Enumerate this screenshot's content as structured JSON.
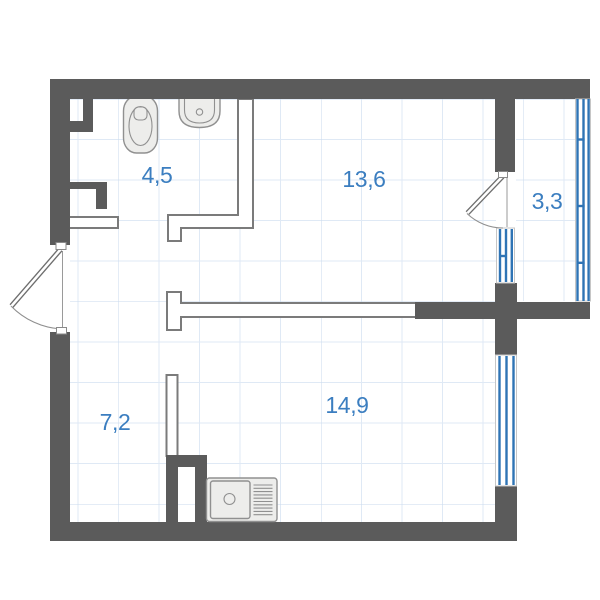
{
  "plan": {
    "rooms": [
      {
        "id": "bathroom",
        "area": "4,5"
      },
      {
        "id": "living-room",
        "area": "13,6"
      },
      {
        "id": "balcony",
        "area": "3,3"
      },
      {
        "id": "hallway",
        "area": "7,2"
      },
      {
        "id": "kitchen-living",
        "area": "14,9"
      }
    ],
    "colors": {
      "wall": "#5b5b5b",
      "partition": "#7b7b7b",
      "window": "#2f74b5",
      "label": "#3b7ec0",
      "grid_minor": "#dfe9f5",
      "grid_major": "#c9daed",
      "fixture_fill": "#ededeb",
      "fixture_stroke": "#909090"
    }
  }
}
